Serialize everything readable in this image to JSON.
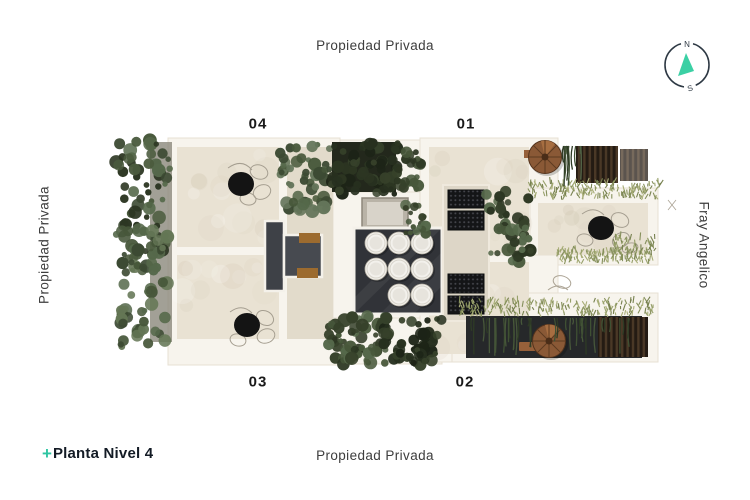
{
  "page": {
    "background": "#ffffff"
  },
  "boundaries": {
    "top": "Propiedad Privada",
    "bottom": "Propiedad Privada",
    "left": "Propiedad Privada",
    "right": "Fray Angelico"
  },
  "units": [
    {
      "label": "04"
    },
    {
      "label": "01"
    },
    {
      "label": "03"
    },
    {
      "label": "02"
    }
  ],
  "compass": {
    "north": "N",
    "south": "S",
    "needle_color": "#3bd0a4",
    "ring_color": "#2e3944"
  },
  "brand": {
    "plus": "+",
    "title": "Planta Nivel 4",
    "plus_color": "#2ec5a2",
    "title_color": "#131b25"
  },
  "palette": {
    "wall": "#f7f4ed",
    "floor": "#e9e2d3",
    "hedge_dark": "#2c3622",
    "hedge_mid": "#47573a",
    "grass": "#97a06a",
    "copper": "#8a5936",
    "core_dark": "#3e4147",
    "skylight_dark": "#313338"
  }
}
